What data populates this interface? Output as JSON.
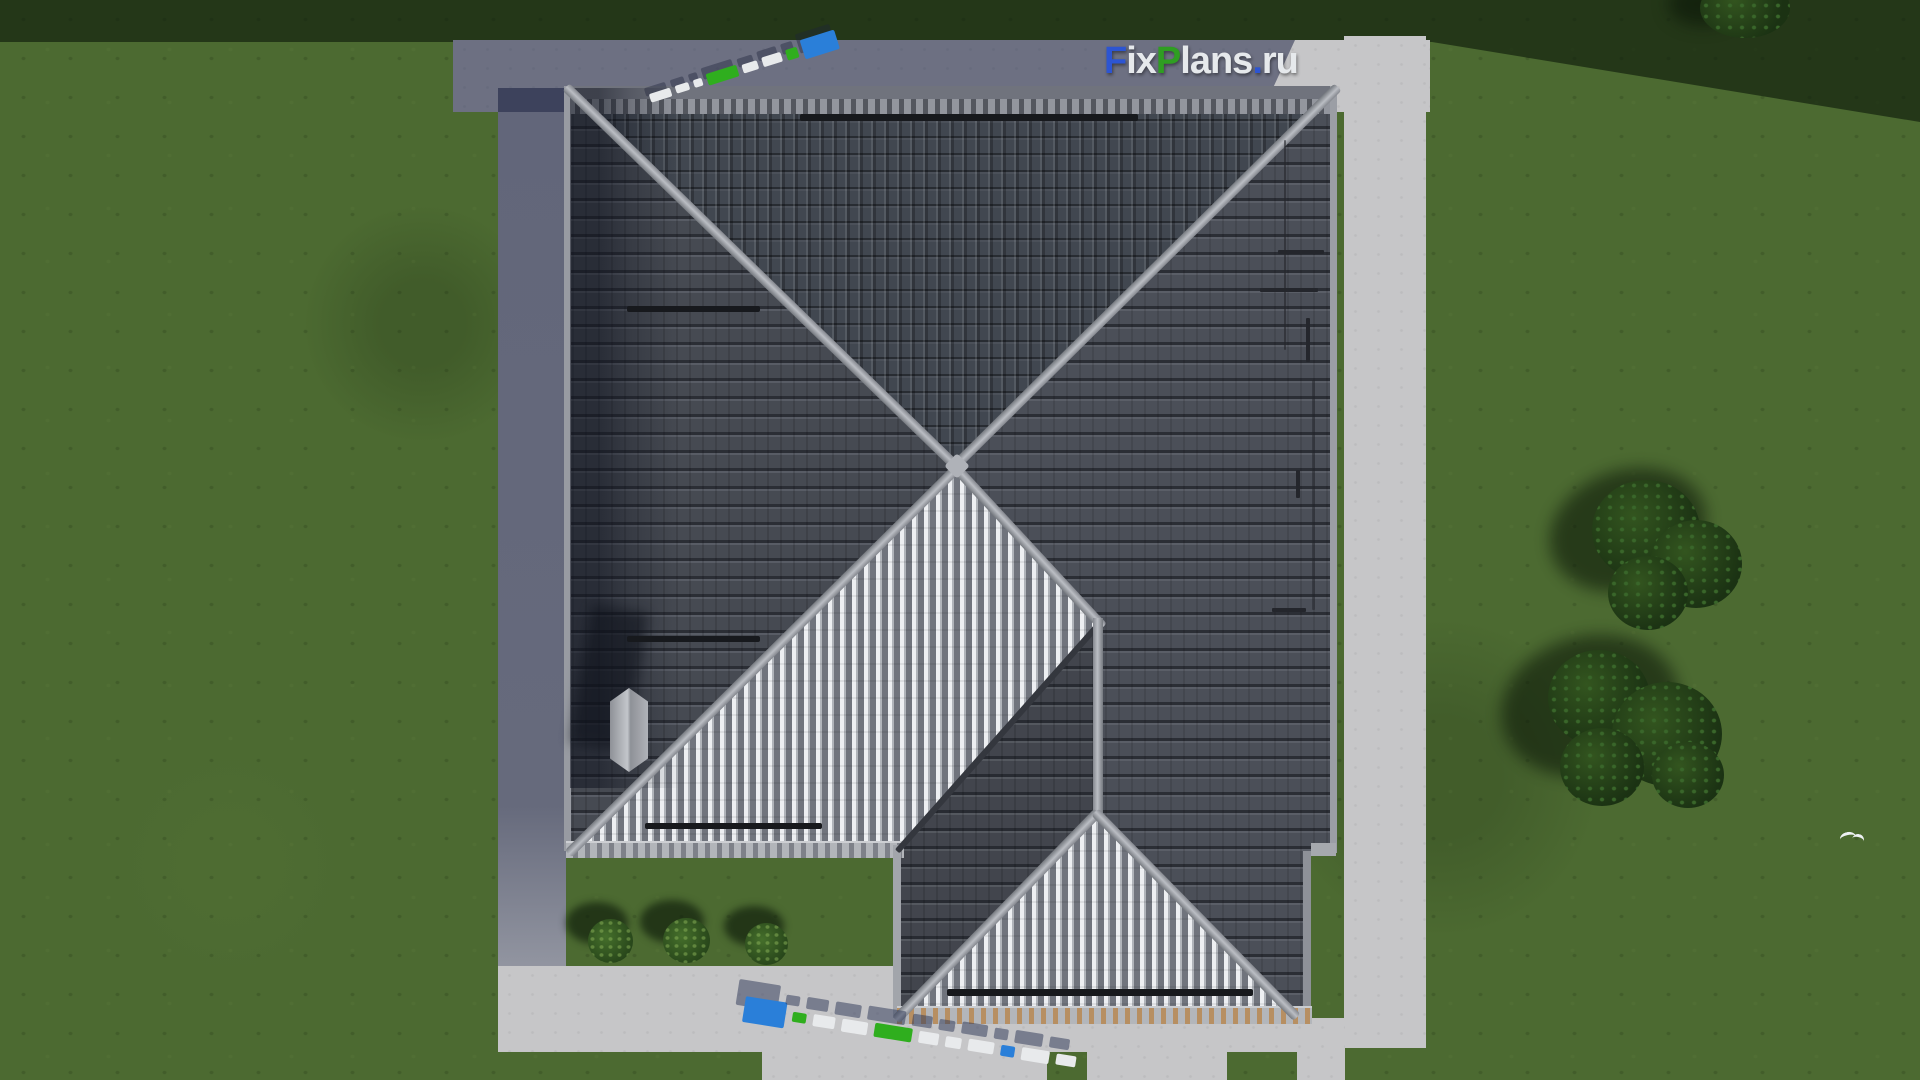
{
  "watermark_logo": {
    "text": "FixPlans.ru",
    "segments": [
      {
        "text": "F",
        "color": "#2d55d2"
      },
      {
        "text": "ix",
        "color": "#e6e9ec"
      },
      {
        "text": "P",
        "color": "#2f9e22"
      },
      {
        "text": "lans",
        "color": "#e6e9ec"
      },
      {
        "text": ".",
        "color": "#2d55d2"
      },
      {
        "text": "ru",
        "color": "#e6e9ec"
      }
    ]
  },
  "palette": {
    "lawn": "#4c6a31",
    "lawn_shadow": "#24371d",
    "path": "#c6c6c8",
    "path_shadow": "#5d6172",
    "roof_dark": "#4a4e57",
    "roof_light": "#d9dbde",
    "ridge": "#a7aab0",
    "eave_tan": "#b78f62",
    "snow_guard": "#17191d",
    "tree_green": "#1f3817",
    "bush_green": "#2f5120",
    "block_blue": "#2a7fd9",
    "block_green": "#2fae1e",
    "block_white": "#e8eaec"
  },
  "ground_markers": {
    "top_strip": [
      {
        "color": "white",
        "w": 22,
        "h": 9
      },
      {
        "color": "white",
        "w": 14,
        "h": 8
      },
      {
        "color": "white",
        "w": 9,
        "h": 8
      },
      {
        "color": "green",
        "w": 32,
        "h": 12
      },
      {
        "color": "white",
        "w": 16,
        "h": 9
      },
      {
        "color": "white",
        "w": 20,
        "h": 10
      },
      {
        "color": "green",
        "w": 12,
        "h": 11
      },
      {
        "color": "blue",
        "w": 36,
        "h": 20
      }
    ],
    "bottom_strip": [
      {
        "color": "blue",
        "w": 42,
        "h": 26
      },
      {
        "color": "green",
        "w": 14,
        "h": 10
      },
      {
        "color": "white",
        "w": 22,
        "h": 12
      },
      {
        "color": "white",
        "w": 26,
        "h": 13
      },
      {
        "color": "green",
        "w": 38,
        "h": 14
      },
      {
        "color": "white",
        "w": 20,
        "h": 12
      },
      {
        "color": "white",
        "w": 16,
        "h": 11
      },
      {
        "color": "white",
        "w": 26,
        "h": 12
      },
      {
        "color": "blue",
        "w": 14,
        "h": 11
      },
      {
        "color": "white",
        "w": 28,
        "h": 13
      },
      {
        "color": "white",
        "w": 20,
        "h": 11
      }
    ]
  }
}
